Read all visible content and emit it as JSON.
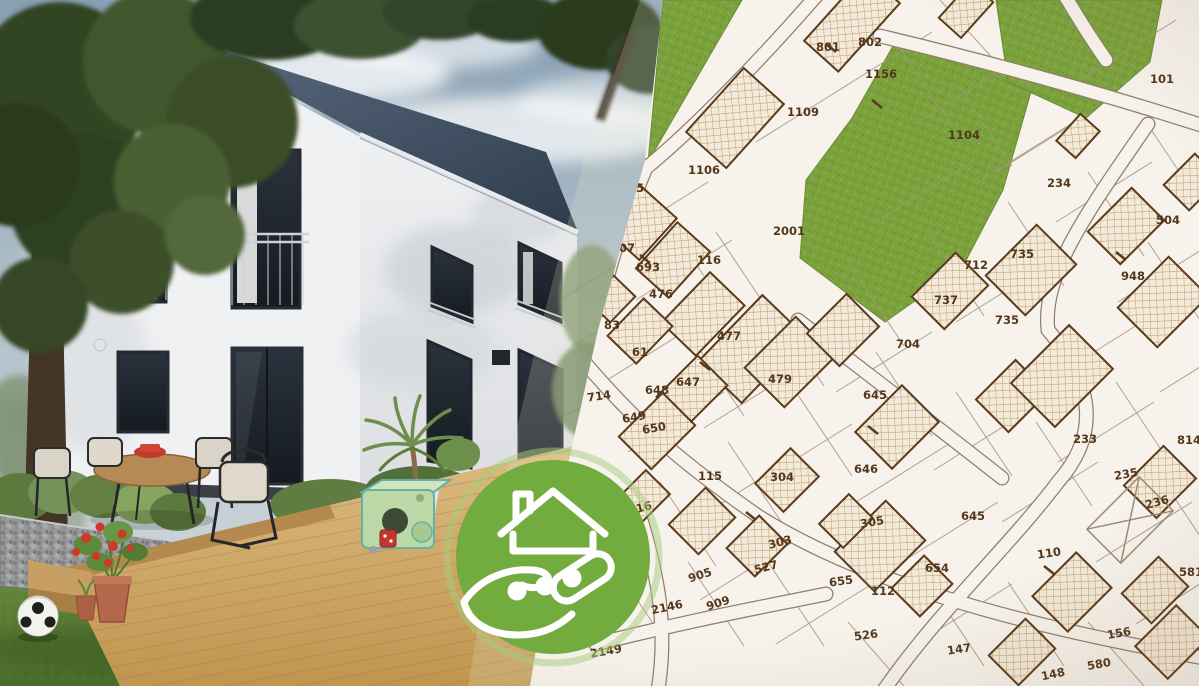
{
  "map": {
    "background": "#f7f3ec",
    "parcel_line_color": "#a4937c",
    "building_outline_color": "#5a3a1c",
    "building_fill_color": "#f4ead9",
    "green_area_color": "#7ca23e",
    "label_color": "#54371b",
    "parcel_labels": [
      [
        "801",
        828,
        47,
        0
      ],
      [
        "802",
        870,
        42,
        0
      ],
      [
        "1156",
        881,
        74,
        0
      ],
      [
        "101",
        1162,
        79,
        0
      ],
      [
        "1109",
        803,
        112,
        0
      ],
      [
        "1104",
        964,
        135,
        0
      ],
      [
        "1106",
        704,
        170,
        0
      ],
      [
        "25",
        636,
        188,
        0
      ],
      [
        "234",
        1059,
        183,
        0
      ],
      [
        "2001",
        789,
        231,
        0
      ],
      [
        "707",
        623,
        248,
        0
      ],
      [
        "504",
        1168,
        220,
        0
      ],
      [
        "116",
        709,
        260,
        0
      ],
      [
        "693",
        648,
        267,
        0
      ],
      [
        "735",
        1022,
        254,
        0
      ],
      [
        "712",
        976,
        265,
        0
      ],
      [
        "948",
        1133,
        276,
        0
      ],
      [
        "737",
        946,
        300,
        0
      ],
      [
        "476",
        661,
        294,
        0
      ],
      [
        "83",
        612,
        325,
        0
      ],
      [
        "735",
        1007,
        320,
        0
      ],
      [
        "61",
        640,
        352,
        0
      ],
      [
        "477",
        729,
        336,
        0
      ],
      [
        "704",
        908,
        344,
        0
      ],
      [
        "647",
        688,
        382,
        0
      ],
      [
        "648",
        657,
        390,
        0
      ],
      [
        "714",
        599,
        396,
        -8
      ],
      [
        "479",
        780,
        379,
        0
      ],
      [
        "645",
        875,
        395,
        0
      ],
      [
        "649",
        634,
        417,
        -10
      ],
      [
        "650",
        654,
        428,
        -10
      ],
      [
        "233",
        1085,
        439,
        0
      ],
      [
        "814",
        1189,
        440,
        0
      ],
      [
        "646",
        866,
        469,
        0
      ],
      [
        "115",
        710,
        476,
        0
      ],
      [
        "304",
        782,
        477,
        0
      ],
      [
        "235",
        1126,
        474,
        -10
      ],
      [
        "116",
        640,
        508,
        -15
      ],
      [
        "236",
        1157,
        502,
        -15
      ],
      [
        "305",
        872,
        522,
        -10
      ],
      [
        "645",
        973,
        516,
        0
      ],
      [
        "303",
        780,
        542,
        -15
      ],
      [
        "110",
        1049,
        553,
        -8
      ],
      [
        "527",
        766,
        567,
        -15
      ],
      [
        "654",
        937,
        568,
        0
      ],
      [
        "905",
        700,
        575,
        -18
      ],
      [
        "655",
        841,
        581,
        -8
      ],
      [
        "112",
        883,
        591,
        0
      ],
      [
        "581",
        1191,
        572,
        0
      ],
      [
        "909",
        718,
        603,
        -18
      ],
      [
        "2146",
        667,
        607,
        -12
      ],
      [
        "526",
        866,
        635,
        -8
      ],
      [
        "156",
        1119,
        633,
        -10
      ],
      [
        "147",
        959,
        649,
        -8
      ],
      [
        "580",
        1099,
        664,
        -10
      ],
      [
        "2149",
        606,
        651,
        -10
      ],
      [
        "148",
        1053,
        674,
        -12
      ]
    ]
  },
  "badge": {
    "color": "#73ac3e",
    "icon": "hand-holding-house-key-icon"
  }
}
